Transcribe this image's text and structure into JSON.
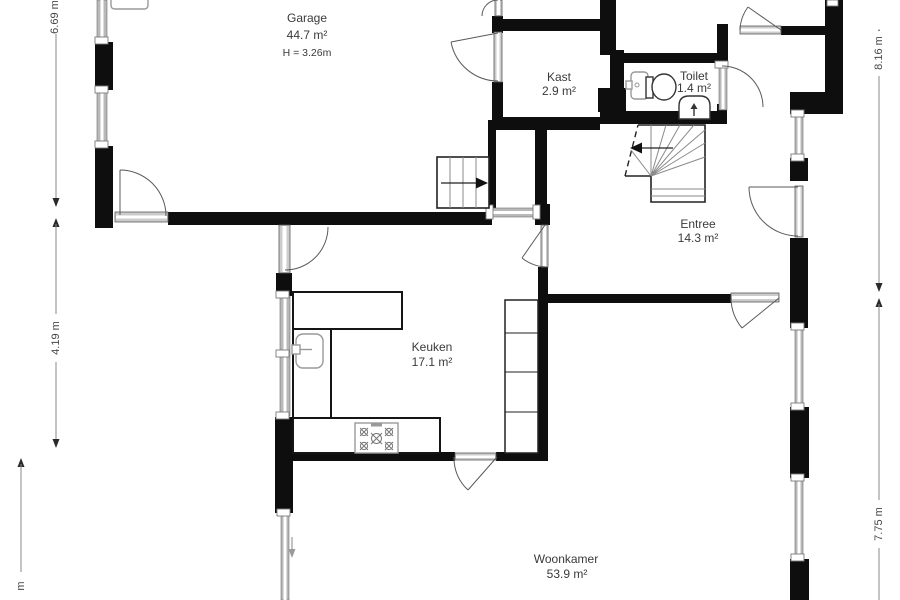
{
  "plan": {
    "rooms": {
      "garage": {
        "name": "Garage",
        "area": "44.7 m²",
        "ceiling_height": "H = 3.26m"
      },
      "kast": {
        "name": "Kast",
        "area": "2.9 m²"
      },
      "toilet": {
        "name": "Toilet",
        "area": "1.4 m²"
      },
      "entree": {
        "name": "Entree",
        "area": "14.3 m²"
      },
      "keuken": {
        "name": "Keuken",
        "area": "17.1 m²"
      },
      "woonkamer": {
        "name": "Woonkamer",
        "area": "53.9 m²"
      }
    },
    "dimensions": {
      "left_upper": "6.69 m",
      "left_middle": "4.19 m",
      "left_lower_partial": "m",
      "right_upper": "8.16 m",
      "right_lower": "7.75 m"
    },
    "colors": {
      "wall": "#0e0e0e",
      "background": "#ffffff",
      "door_line": "#5a5a5a",
      "window_fill": "#b9b9b9",
      "text": "#3a3a3a"
    }
  }
}
